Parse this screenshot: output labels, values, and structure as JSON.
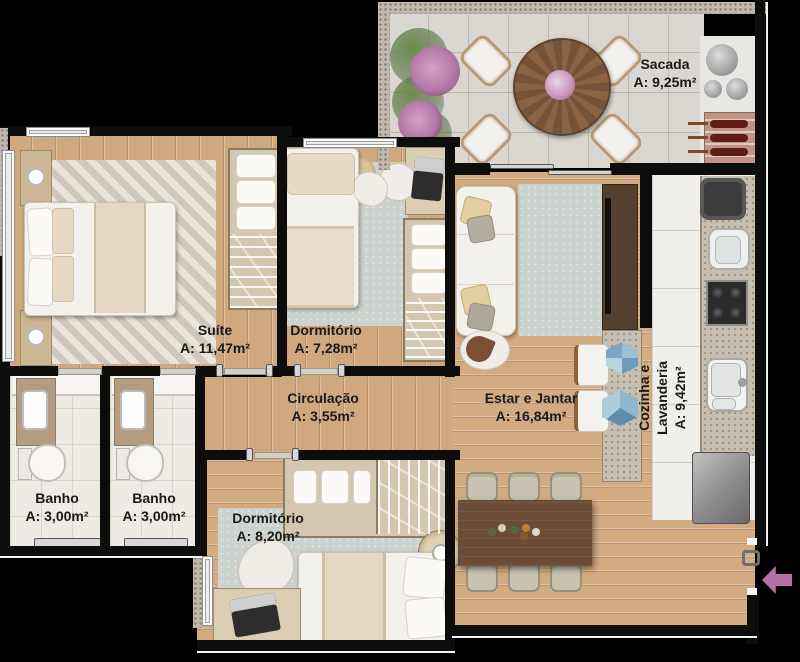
{
  "plan_title": "Apartment floor plan",
  "colors": {
    "background": "#000000",
    "wood_floor": "#cfa87e",
    "balcony_tile": "#dad7d1",
    "kitchen_floor": "#f1efeb",
    "bath_floor": "#eeebe5",
    "wall": "#0d0d0d",
    "label_text": "#1a1a1a",
    "entrance_arrow": "#b571a5",
    "rug": "#ccd3cf",
    "dark_wood": "#6b4c36"
  },
  "rooms": [
    {
      "id": "sacada",
      "name": "Sacada",
      "area": "A: 9,25m²"
    },
    {
      "id": "suite",
      "name": "Suíte",
      "area": "A: 11,47m²"
    },
    {
      "id": "dormitorio-1",
      "name": "Dormitório",
      "area": "A: 7,28m²"
    },
    {
      "id": "circulacao",
      "name": "Circulação",
      "area": "A: 3,55m²"
    },
    {
      "id": "estar-jantar",
      "name": "Estar e Jantar",
      "area": "A: 16,84m²"
    },
    {
      "id": "cozinha-lavanderia",
      "name_line1": "Cozinha e",
      "name_line2": "Lavanderia",
      "area": "A: 9,42m²"
    },
    {
      "id": "banho-1",
      "name": "Banho",
      "area": "A: 3,00m²"
    },
    {
      "id": "banho-2",
      "name": "Banho",
      "area": "A: 3,00m²"
    },
    {
      "id": "dormitorio-2",
      "name": "Dormitório",
      "area": "A: 8,20m²"
    }
  ]
}
